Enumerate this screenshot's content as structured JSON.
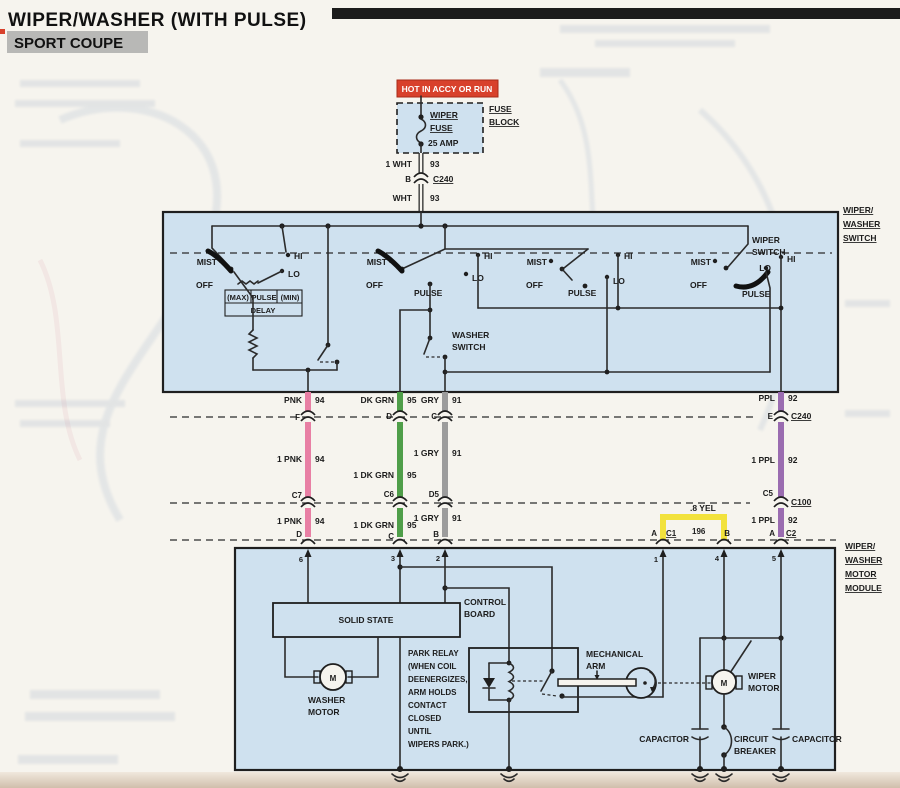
{
  "header": {
    "title": "WIPER/WASHER (WITH PULSE)",
    "subtitle": "SPORT COUPE"
  },
  "fuse": {
    "hot": "HOT IN ACCY OR RUN",
    "wiper": "WIPER",
    "fuse": "FUSE",
    "amp": "25 AMP",
    "block_l1": "FUSE",
    "block_l2": "BLOCK"
  },
  "feed": {
    "w1": "1 WHT",
    "n1": "93",
    "pin": "B",
    "conn": "C240",
    "w2": "WHT",
    "n2": "93"
  },
  "sw": {
    "side_l1": "WIPER/",
    "side_l2": "WASHER",
    "side_l3": "SWITCH",
    "mist": "MIST",
    "off": "OFF",
    "hi": "HI",
    "lo": "LO",
    "pulse": "PULSE",
    "max": "(MAX)",
    "min": "(MIN)",
    "delay": "DELAY",
    "wiper_sw_l1": "WIPER",
    "wiper_sw_l2": "SWITCH",
    "washer_sw_l1": "WASHER",
    "washer_sw_l2": "SWITCH"
  },
  "wires": {
    "pnk": {
      "name": "PNK",
      "num": "94",
      "f": "F",
      "seg": "1 PNK",
      "c7": "C7",
      "pin": "D"
    },
    "grn": {
      "name": "DK GRN",
      "num": "95",
      "d": "D",
      "seg": "1 DK GRN",
      "c6": "C6",
      "pin": "C"
    },
    "gry": {
      "name": "GRY",
      "num": "91",
      "c": "C",
      "seg": "1 GRY",
      "d5": "D5",
      "pin": "B"
    },
    "ppl": {
      "name": "PPL",
      "num": "92",
      "e": "E",
      "c240": "C240",
      "seg": "1 PPL",
      "c5": "C5",
      "c100": "C100",
      "pin_a": "A",
      "c2": "C2"
    },
    "yel": {
      "label": ".8 YEL",
      "a": "A",
      "c1": "C1",
      "num": "196",
      "b": "B"
    }
  },
  "mod": {
    "side_l1": "WIPER/",
    "side_l2": "WASHER",
    "side_l3": "MOTOR",
    "side_l4": "MODULE",
    "pins": {
      "p6": "6",
      "p3": "3",
      "p2": "2",
      "p1": "1",
      "p4": "4",
      "p5": "5"
    },
    "solid_state": "SOLID STATE",
    "control_l1": "CONTROL",
    "control_l2": "BOARD",
    "m": "M",
    "washer_l1": "WASHER",
    "washer_l2": "MOTOR",
    "relay": [
      "PARK RELAY",
      "(WHEN COIL",
      "DEENERGIZES,",
      "ARM HOLDS",
      "CONTACT",
      "CLOSED",
      "UNTIL",
      "WIPERS PARK.)"
    ],
    "arm_l1": "MECHANICAL",
    "arm_l2": "ARM",
    "wiper_l1": "WIPER",
    "wiper_l2": "MOTOR",
    "cap": "CAPACITOR",
    "cb_l1": "CIRCUIT",
    "cb_l2": "BREAKER"
  },
  "colors": {
    "pnk": "#e87fa4",
    "grn": "#4f9e49",
    "gry": "#9c9c9c",
    "ppl": "#9a6cb0",
    "yel": "#f2e23c",
    "red": "#d8412c",
    "box": "#cfe1ef",
    "line": "#2b2b2b",
    "paper": "#f6f4ee"
  }
}
